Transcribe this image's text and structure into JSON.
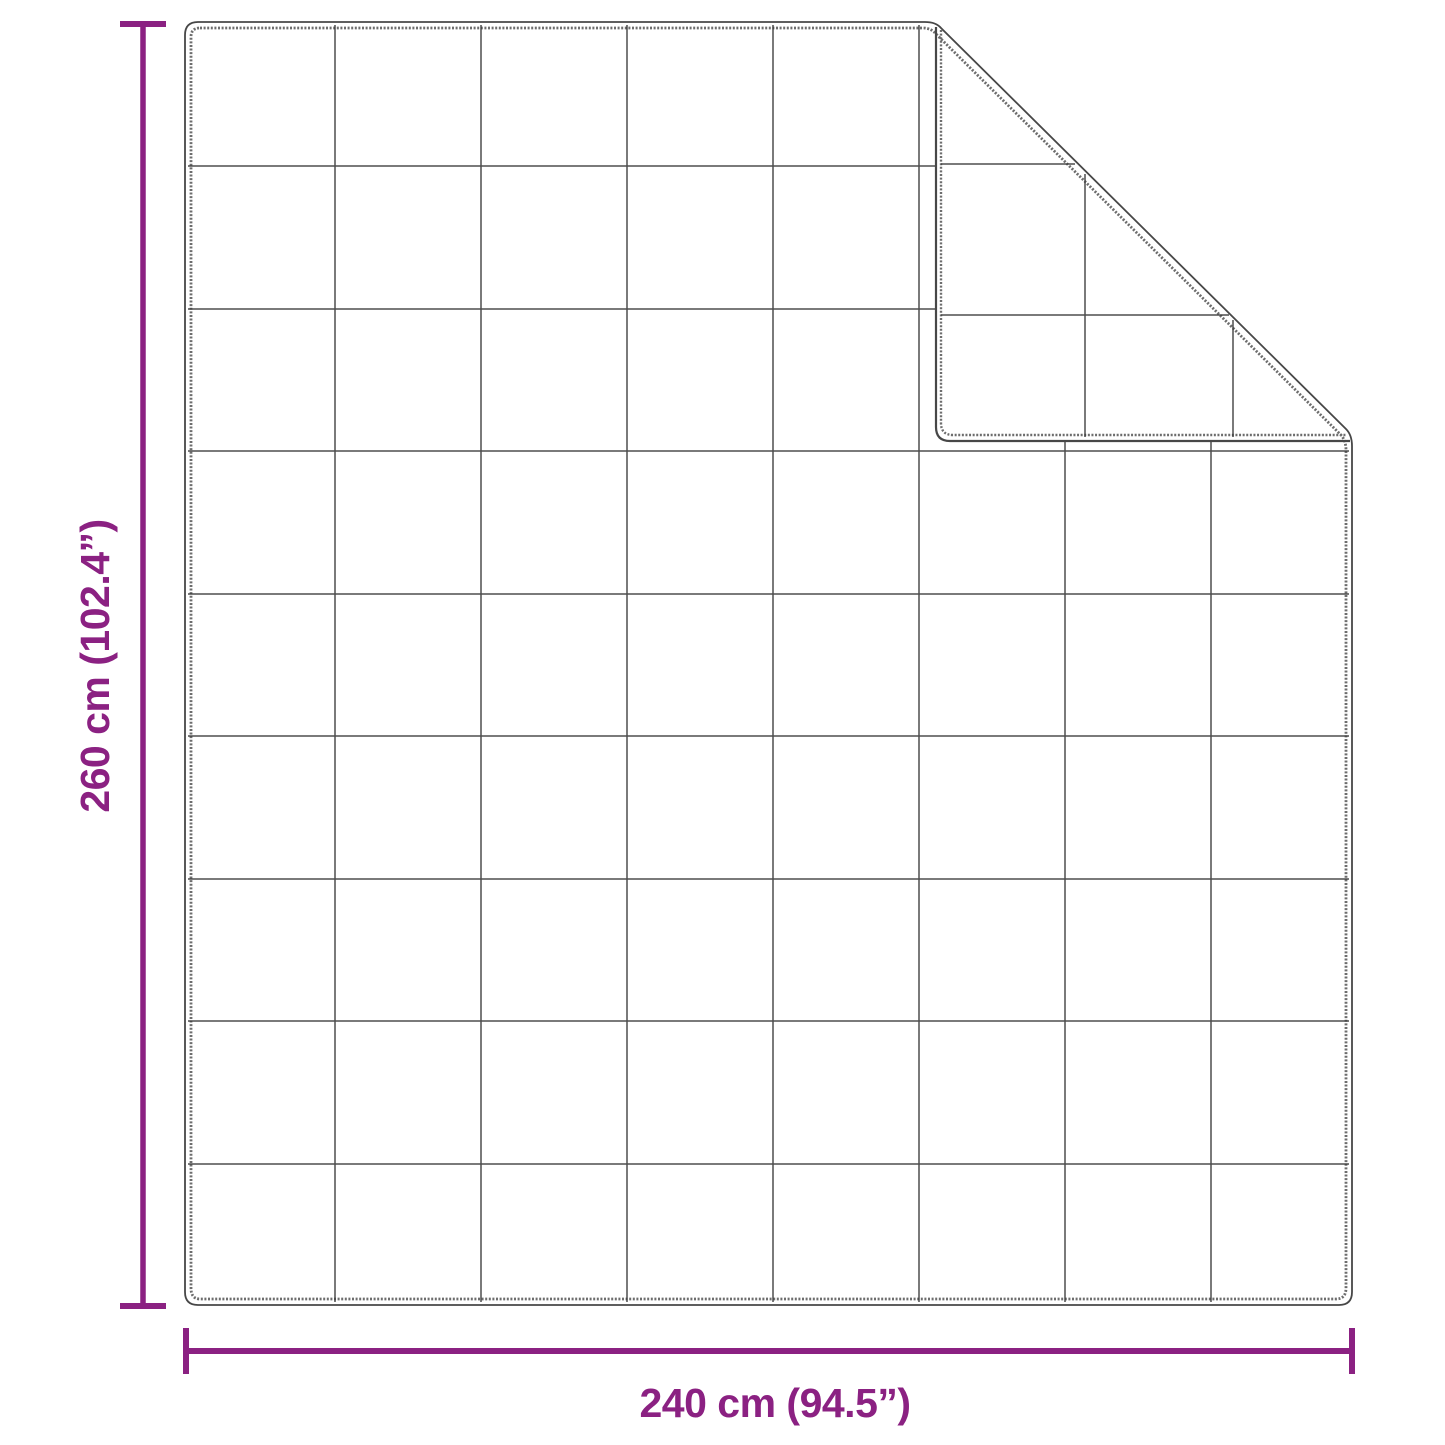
{
  "page": {
    "background": "#ffffff"
  },
  "diagram": {
    "kind": "product-dimension-diagram",
    "subject": "quilted blanket with folded top-right corner",
    "colors": {
      "dimension": "#8b2182",
      "outline": "#474747",
      "stitch": "#6d6d6d",
      "grid": "#3b3b3b"
    },
    "dimensions": {
      "height": {
        "label": "260 cm (102.4”)",
        "value_cm": 260,
        "value_inch": 102.4
      },
      "width": {
        "label": "240 cm (94.5”)",
        "value_cm": 240,
        "value_inch": 94.5
      }
    },
    "grid": {
      "body_columns": 8,
      "body_rows": 9,
      "flap_grid_columns": 3,
      "flap_grid_rows": 3,
      "square_px": 146
    }
  }
}
